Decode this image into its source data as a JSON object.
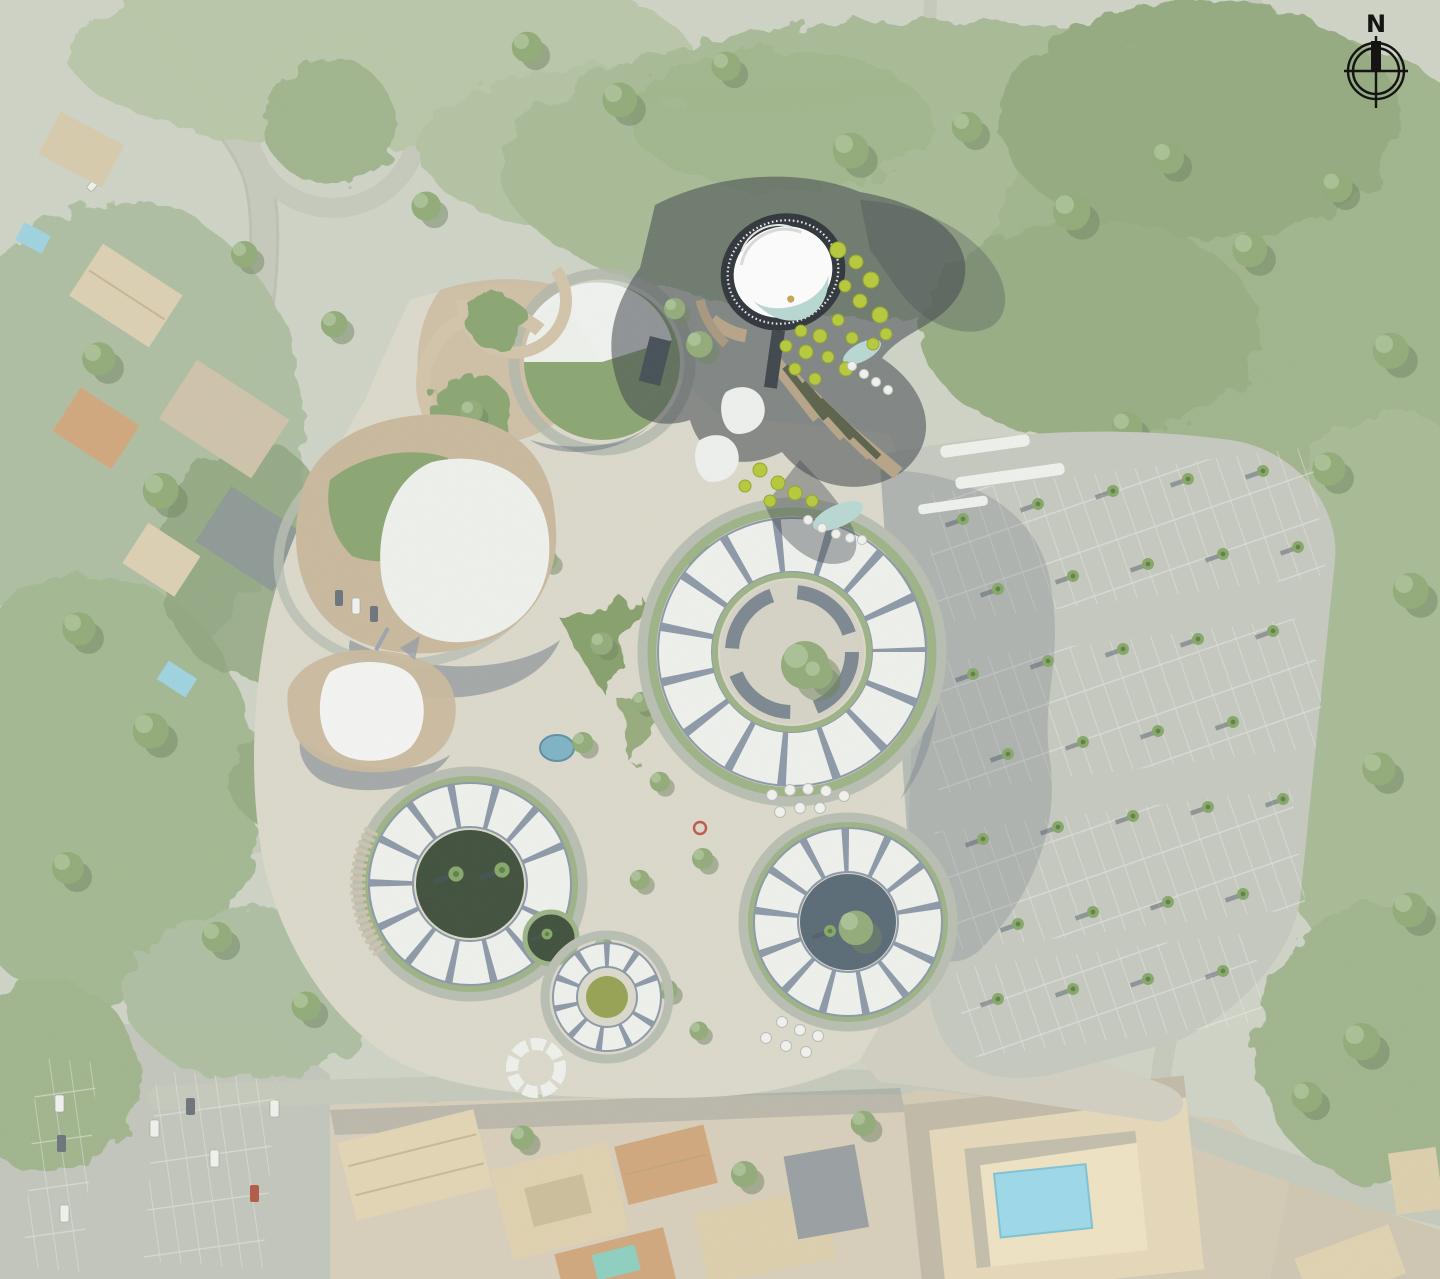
{
  "title": "Aerial masterplan site view",
  "compass": {
    "label": "N"
  },
  "palette": {
    "base": "#cfd4c7",
    "veg_light": "#b9c7a8",
    "veg_mid": "#9fb48b",
    "veg_dark": "#87a076",
    "road": "#c6cabd",
    "plaza": "#dcd9cb",
    "promenade": "#d2cfc2",
    "parking": "#c6c9c0",
    "building_white": "#eff1ed",
    "hedge_green": "#9eb387",
    "spoke_gray": "#8d99a8",
    "courtyard_dark": "#40503d",
    "courtyard_slate": "#5a6a76",
    "lawn": "#8ba572",
    "deck_tan": "#c9b99e",
    "town_ground": "#d8cfbb",
    "roof_tan": "#e3d6b6",
    "roof_terracotta": "#d2a87e",
    "roof_slate": "#9aa0a3",
    "pool_blue": "#9ed9ea",
    "pond_blue": "#7fb3c6",
    "pond_olive": "#97a254",
    "tower_ring_dark": "#2f353b",
    "tower_roof_white": "#fdfdfd",
    "tower_shadow": "#3f464c",
    "water_teal": "#b9d8d3",
    "tree_chartreuse": "#b7c93c",
    "ball_white": "#f2f2ef",
    "gold_accent": "#c8a25a",
    "sculpture_red": "#c25648",
    "compass_ink": "#141414"
  },
  "features": [
    "aerial-photo-context",
    "residential-area-northwest",
    "forest-top-right",
    "loop-road-north",
    "highlighted-spiral-tower",
    "tower-cast-shadow",
    "event-pavilion-west",
    "tent-pavilion-west",
    "lawn-dome-pavilion-north",
    "ring-building-central",
    "ring-building-southwest",
    "ring-building-south",
    "central-plaza",
    "plaza-pond",
    "palm-tree-parking-east",
    "town-fabric-south",
    "courtyard-pool-building-southeast",
    "compass-rose"
  ]
}
